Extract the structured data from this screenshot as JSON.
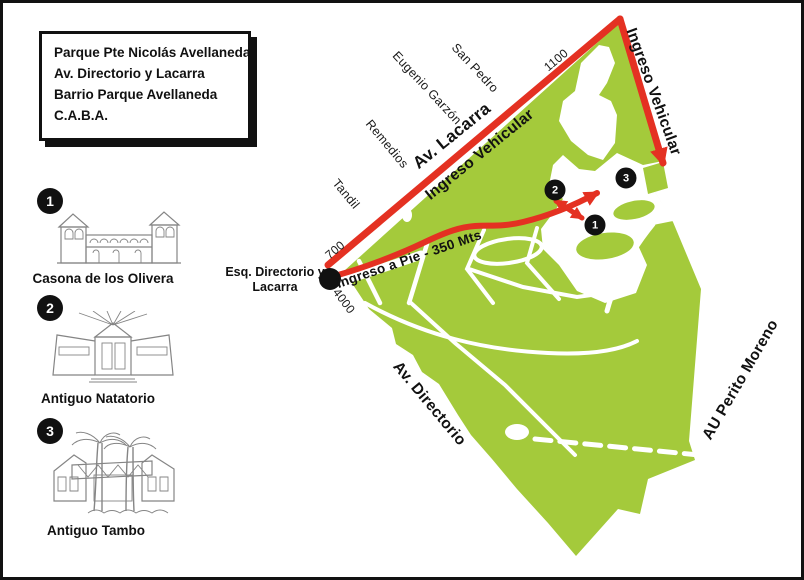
{
  "title_box": {
    "lines": [
      "Parque Pte Nicolás Avellaneda",
      "Av. Directorio y Lacarra",
      "Barrio Parque Avellaneda",
      "C.A.B.A."
    ]
  },
  "legend": {
    "items": [
      {
        "number": "1",
        "name": "Casona de los Olivera"
      },
      {
        "number": "2",
        "name": "Antiguo Natatorio"
      },
      {
        "number": "3",
        "name": "Antiguo Tambo"
      }
    ]
  },
  "map": {
    "streets": {
      "tandil": "Tandil",
      "remedios": "Remedios",
      "eugenio_garzon": "Eugenio Garzón",
      "san_pedro": "San Pedro",
      "av_lacarra": "Av. Lacarra",
      "av_directorio": "Av. Directorio",
      "au_perito_moreno": "AU Perito Moreno"
    },
    "address_numbers": {
      "n700": "700",
      "n1100": "1100",
      "n4000": "4000"
    },
    "routes": {
      "ingreso_vehicular_lacarra": "Ingreso Vehicular",
      "ingreso_vehicular_autopista": "Ingreso Vehicular",
      "ingreso_a_pie": "Ingreso a Pie - 350 Mts"
    },
    "entrance": {
      "line1": "Esq. Directorio y",
      "line2": "Lacarra"
    },
    "markers": [
      {
        "number": "1"
      },
      {
        "number": "2"
      },
      {
        "number": "3"
      }
    ],
    "colors": {
      "park_green": "#a4ca3b",
      "route_red": "#e43122",
      "marker_black": "#111111"
    }
  }
}
